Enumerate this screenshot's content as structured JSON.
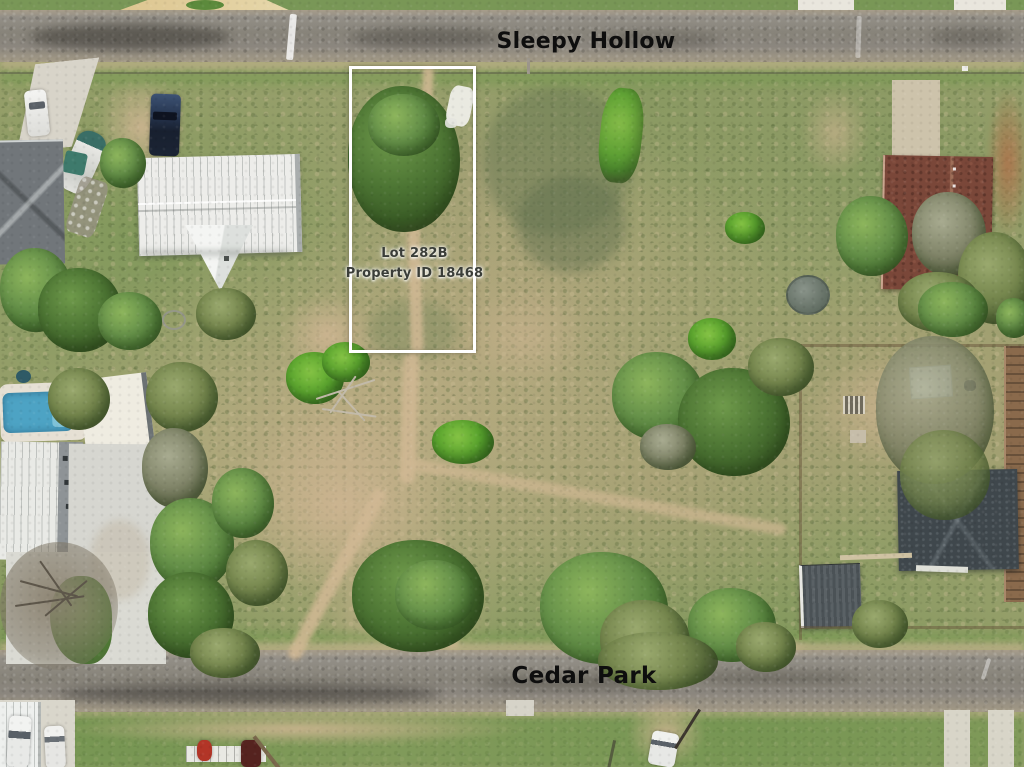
{
  "annotations": {
    "street_top": "Sleepy Hollow",
    "street_bottom": "Cedar Park",
    "lot_label_line1": "Lot 282B",
    "lot_label_line2": "Property ID 18468"
  },
  "palette": {
    "boundary_white": "#ffffff",
    "street_text": "#0e0e0e",
    "lot_text": "#3a3d38",
    "road_asphalt": "#8c8880",
    "grass_base": "#9aa06d",
    "dirt_tan": "#c9b190",
    "tree_green": "#5d8540",
    "pool_blue": "#4da3c4",
    "white_roof": "#ededea",
    "gray_roof": "#71767a",
    "brown_roof": "#7a4739",
    "charcoal_roof": "#3f474c",
    "concrete": "#d7d5cc"
  }
}
